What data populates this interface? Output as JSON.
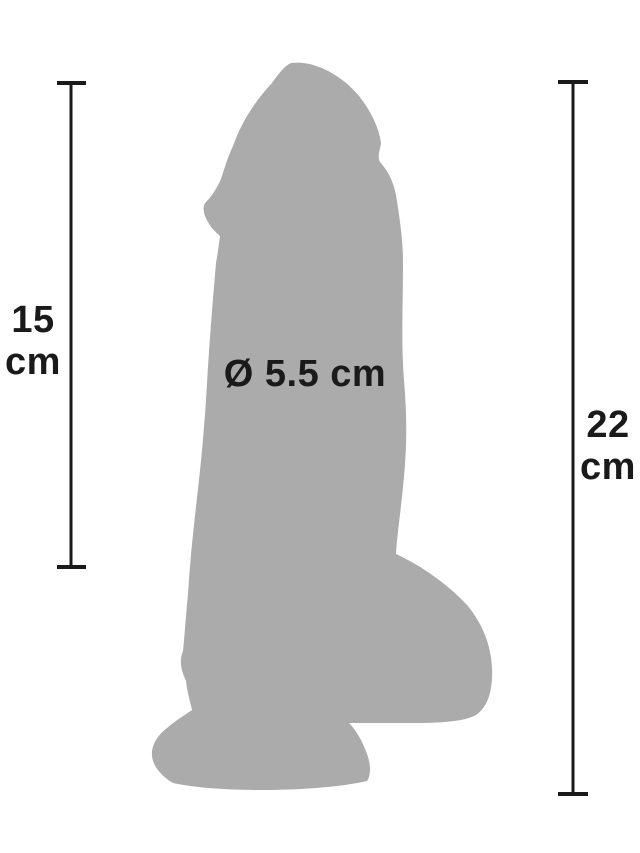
{
  "page": {
    "background_color": "#ffffff"
  },
  "figure": {
    "kind": "product-dimension-diagram",
    "silhouette_color": "#ababab",
    "line_color": "#1a1a1a",
    "measurements": {
      "left": {
        "value": "15",
        "unit": "cm",
        "label": "15 cm"
      },
      "right": {
        "value": "22",
        "unit": "cm",
        "label": "22 cm"
      },
      "diameter": {
        "label": "Ø 5.5 cm",
        "value": "5.5",
        "unit": "cm",
        "symbol": "Ø"
      }
    }
  }
}
